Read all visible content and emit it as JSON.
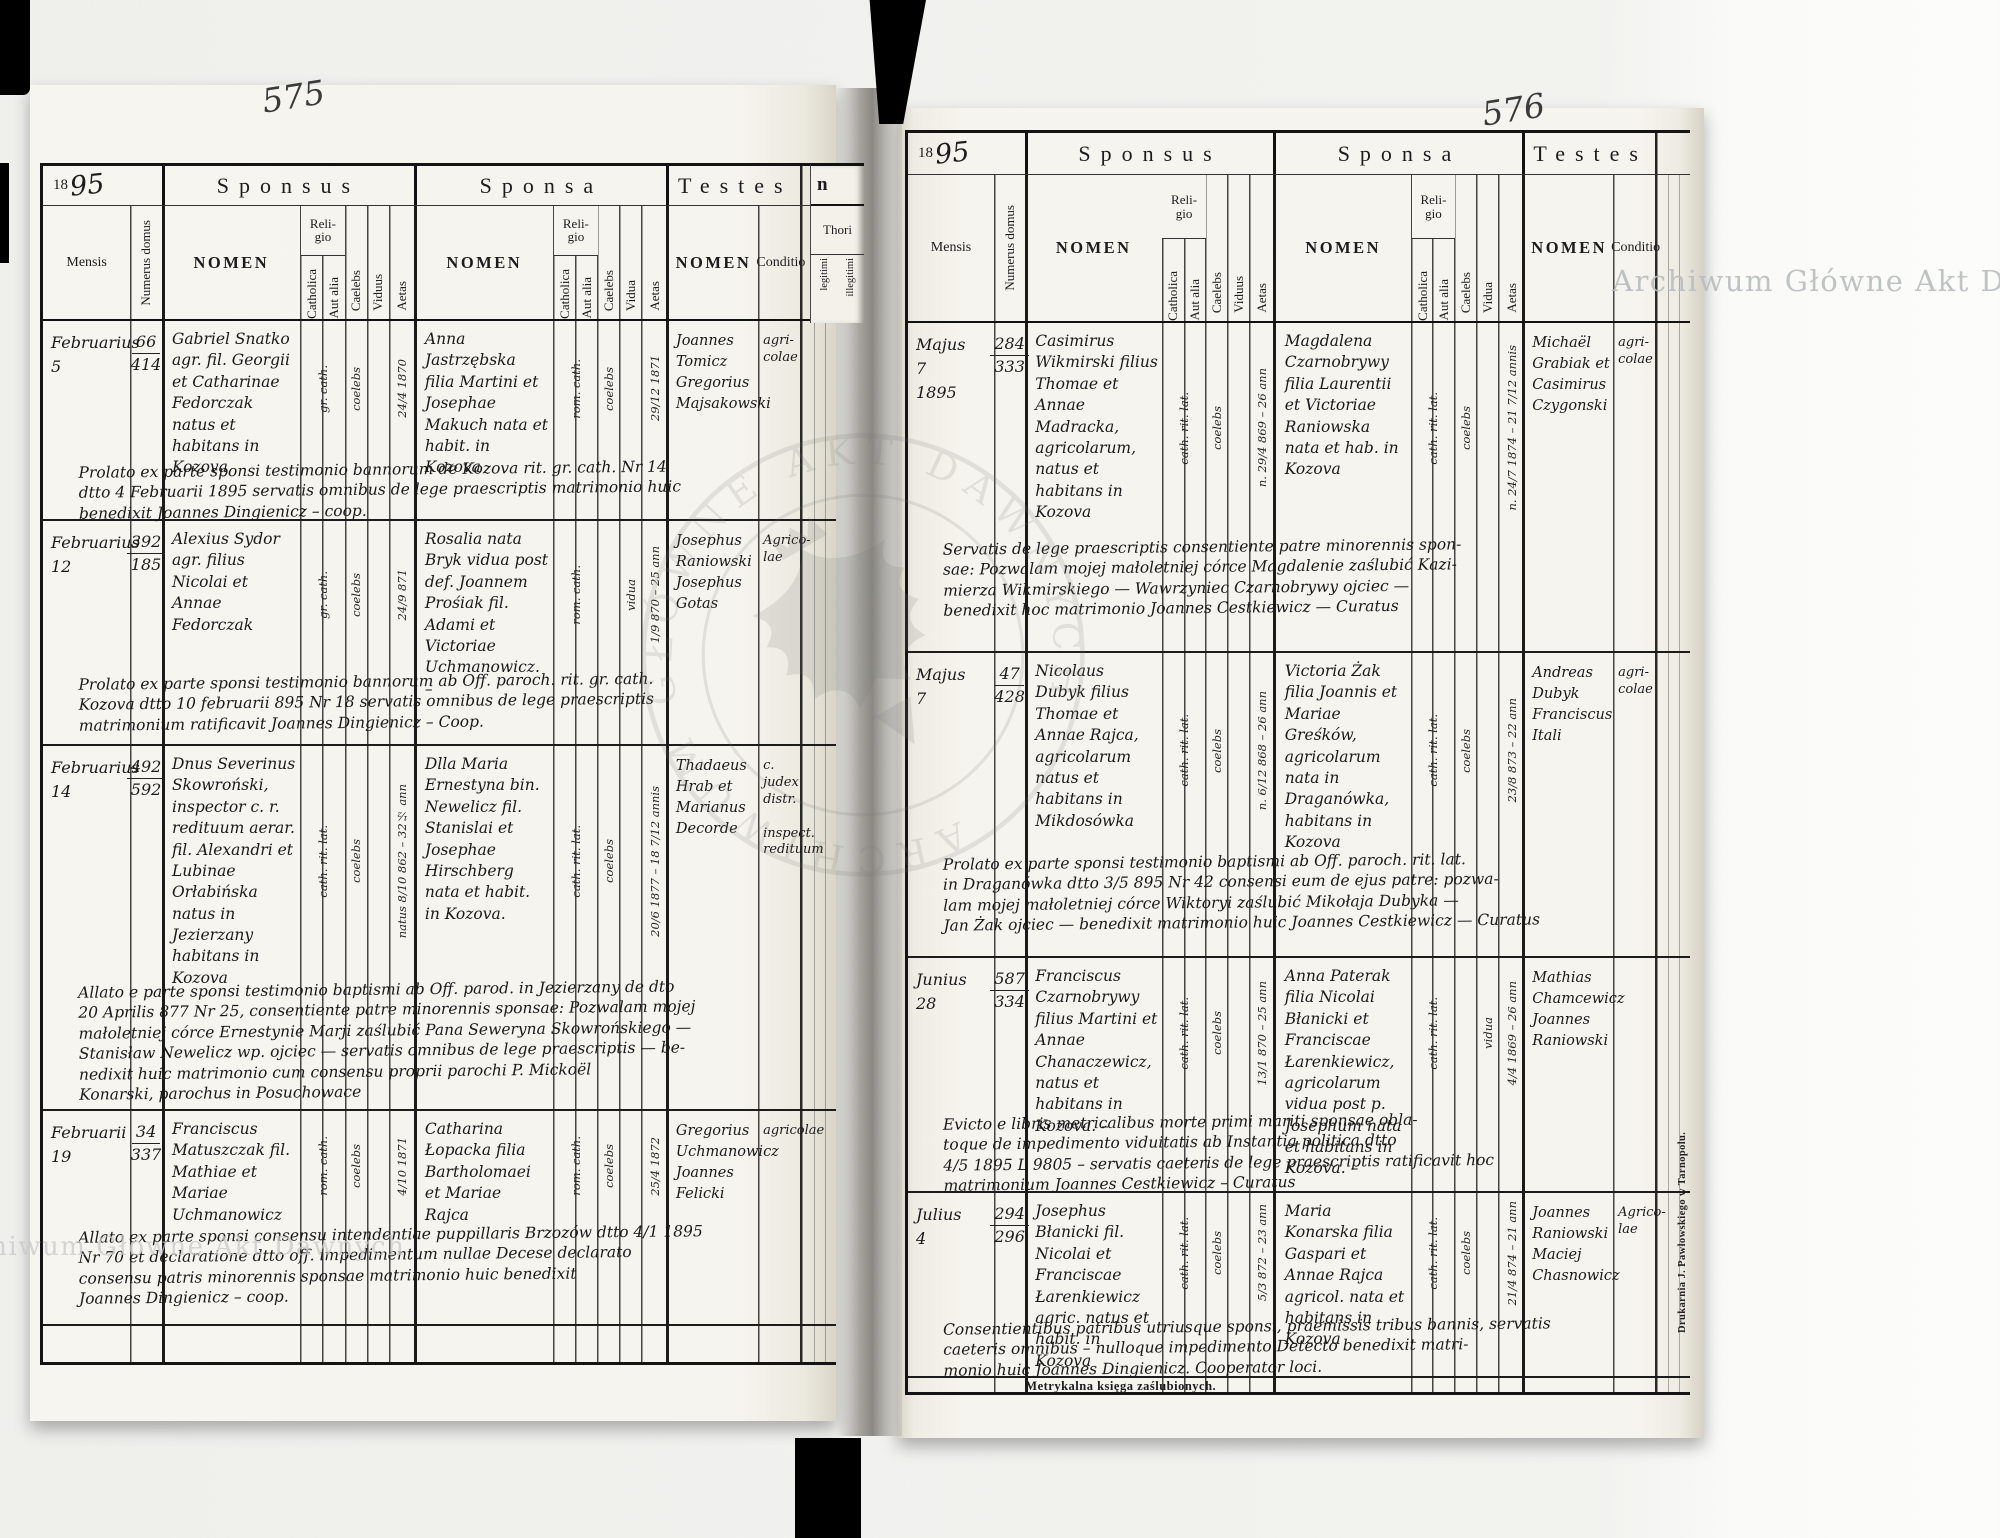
{
  "watermarks": {
    "archive": "Archiwum Główne Akt Dawnych",
    "stamp_text": "ARCHIWUM GŁÓWNE AKT DAWNYCH"
  },
  "headers": {
    "year_printed": "18",
    "sponsus": "Sponsus",
    "sponsa": "Sponsa",
    "testes": "Testes",
    "mensis": "Mensis",
    "numerus_domus": "Numerus domus",
    "nomen": "NOMEN",
    "religio": "Reli-\ngio",
    "catholica": "Catholica",
    "aut_alia": "Aut alia",
    "caelebs": "Caelebs",
    "viduus": "Viduus",
    "vidua": "Vidua",
    "aetas": "Aetas",
    "conditio": "Conditio",
    "fragment_n": "n",
    "thori": "Thori",
    "legitimi": "legitimi",
    "illegitimi": "illegitimi"
  },
  "left": {
    "page_number": "575",
    "year_hand": "95",
    "entries": [
      {
        "mensis": "Februarius\n5",
        "num_top": "66",
        "num_bot": "414",
        "sponsus": "Gabriel Snatko agr. fil. Georgii et Catharinae Fedorczak natus et habitans in Kozova",
        "sp_religio": "gr. cath.",
        "sp_status": "coelebs",
        "sp_aetas": "24/4 1870",
        "sponsa": "Anna Jastrzębska filia Martini et Josephae Makuch nata et habit. in Kozova",
        "sa_religio": "rom. cath.",
        "sa_status": "coelebs",
        "sa_aetas": "29/12 1871",
        "testes": "Joannes Tomicz Gregorius Majsakowski",
        "conditio": "agri-\ncolae",
        "note": "Prolato ex parte sponsi testimonio bannorum de Kozova rit. gr. cath. Nr 14\ndtto 4 Februarii 1895 servatis omnibus de lege praescriptis matrimonio huic\nbenedixit Joannes Dingienicz – coop."
      },
      {
        "mensis": "Februarius\n12",
        "num_top": "392",
        "num_bot": "185",
        "sponsus": "Alexius Sydor agr. filius Nicolai et Annae Fedorczak",
        "sp_religio": "gr. cath.",
        "sp_status": "coelebs",
        "sp_aetas": "24/9 871",
        "sponsa": "Rosalia nata Bryk vidua post def. Joannem Prośiak fil. Adami et Victoriae Uchmanowicz. –",
        "sa_religio": "rom. cath.",
        "sa_status": "vidua",
        "sa_aetas": "1/9 870 – 25 ann",
        "testes": "Josephus Raniowski Josephus Gotas",
        "conditio": "Agrico-\nlae",
        "note": "Prolato ex parte sponsi testimonio bannorum ab Off. paroch. rit. gr. cath.\nKozova dtto 10 februarii 895 Nr 18 servatis omnibus de lege praescriptis\nmatrimonium ratificavit Joannes Dingienicz – Coop."
      },
      {
        "mensis": "Februarius\n14",
        "num_top": "492",
        "num_bot": "592",
        "sponsus": "Dnus Severinus Skowroński, inspector c. r. redituum aerar. fil. Alexandri et Lubinae Orłabińska natus in Jezierzany habitans in Kozova",
        "sp_religio": "cath. rit. lat.",
        "sp_status": "coelebs",
        "sp_aetas": "natus 8/10 862 – 32½ ann",
        "sponsa": "Dlla Maria Ernestyna bin. Newelicz fil. Stanislai et Josephae Hirschberg nata et habit. in Kozova.",
        "sa_religio": "cath. rit. lat.",
        "sa_status": "coelebs",
        "sa_aetas": "20/6 1877 – 18 7/12 annis",
        "testes": "Thadaeus Hrab et Marianus Decorde",
        "conditio": "c. judex distr.\n\ninspect. redituum",
        "note": "Allato e parte sponsi testimonio baptismi ab Off. parod. in Jezierzany de dto\n20 Aprilis 877 Nr 25, consentiente patre minorennis sponsae: Pozwalam mojej\nmałoletniej córce Ernestynie Marji zaślubić Pana Seweryna Skowrońskiego —\nStanisław Newelicz wp. ojciec — servatis omnibus de lege praescriptis — be-\nnedixit huic matrimonio cum consensu proprii parochi P. Mickoël\nKonarski, parochus in Posuchowace"
      },
      {
        "mensis": "Februarii\n19",
        "num_top": "34",
        "num_bot": "337",
        "sponsus": "Franciscus Matuszczak fil. Mathiae et Mariae Uchmanowicz",
        "sp_religio": "rom. cath.",
        "sp_status": "coelebs",
        "sp_aetas": "4/10 1871",
        "sponsa": "Catharina Łopacka filia Bartholomaei et Mariae Rajca",
        "sa_religio": "rom. cath.",
        "sa_status": "coelebs",
        "sa_aetas": "25/4 1872",
        "testes": "Gregorius Uchmanowicz Joannes Felicki",
        "conditio": "agricolae",
        "note": "Allato ex parte sponsi consensu intendentiae puppillaris Brzozów dtto 4/1 1895\nNr 70 et declaratione dtto off. impedimentum nullae Decese declarato\nconsensu patris minorennis sponsae matrimonio huic benedixit\nJoannes Dingienicz – coop."
      }
    ]
  },
  "right": {
    "page_number": "576",
    "year_hand": "95",
    "caption": "Metrykalna księga zaślubionych.",
    "printer": "Drukarnia J. Pawłowskiego w Tarnopolu.",
    "entries": [
      {
        "mensis": "Majus\n7\n1895",
        "num_top": "284",
        "num_bot": "333",
        "sponsus": "Casimirus Wikmirski filius Thomae et Annae Madracka, agricolarum, natus et habitans in Kozova",
        "sp_religio": "cath. rit. lat.",
        "sp_status": "coelebs",
        "sp_aetas": "n. 29/4 869 – 26 ann",
        "sponsa": "Magdalena Czarnobrywy filia Laurentii et Victoriae Raniowska nata et hab. in Kozova",
        "sa_religio": "cath. rit. lat.",
        "sa_status": "coelebs",
        "sa_aetas": "n. 24/7 1874 – 21 7/12 annis",
        "testes": "Michaël Grabiak et Casimirus Czygonski",
        "conditio": "agri-\ncolae",
        "note": "Servatis de lege praescriptis consentiente patre minorennis spon-\nsae: Pozwalam mojej małoletniej córce Magdalenie zaślubić Kazi-\nmierza Wikmirskiego — Wawrzyniec Czarnobrywy ojciec —\nbenedixit hoc matrimonio Joannes Cestkiewicz — Curatus"
      },
      {
        "mensis": "Majus\n7",
        "num_top": "47",
        "num_bot": "428",
        "sponsus": "Nicolaus Dubyk filius Thomae et Annae Rajca, agricolarum natus et habitans in Mikdosówka",
        "sp_religio": "cath. rit. lat.",
        "sp_status": "coelebs",
        "sp_aetas": "n. 6/12 868 – 26 ann",
        "sponsa": "Victoria Żak filia Joannis et Mariae Greśków, agricolarum nata in Draganówka, habitans in Kozova",
        "sa_religio": "cath. rit. lat.",
        "sa_status": "coelebs",
        "sa_aetas": "23/8 873 – 22 ann",
        "testes": "Andreas Dubyk Franciscus Itali",
        "conditio": "agri-\ncolae",
        "note": "Prolato ex parte sponsi testimonio baptismi ab Off. paroch. rit. lat.\nin Draganówka dtto 3/5 895 Nr 42 consensi eum de ejus patre: pozwa-\nlam mojej małoletniej córce Wiktoryi zaślubić Mikołaja Dubyka —\nJan Żak ojciec — benedixit matrimonio huic Joannes Cestkiewicz — Curatus"
      },
      {
        "mensis": "Junius\n28",
        "num_top": "587",
        "num_bot": "334",
        "sponsus": "Franciscus Czarnobrywy filius Martini et Annae Chanaczewicz, natus et habitans in Kozova. –",
        "sp_religio": "cath. rit. lat.",
        "sp_status": "coelebs",
        "sp_aetas": "13/1 870 – 25 ann",
        "sponsa": "Anna Paterak filia Nicolai Błanicki et Franciscae Łarenkiewicz, agricolarum vidua post p. Josephum nata et habitans in Kozova. –",
        "sa_religio": "cath. rit. lat.",
        "sa_status": "vidua",
        "sa_aetas": "4/4 1869 – 26 ann",
        "testes": "Mathias Chamcewicz Joannes Raniowski",
        "conditio": "",
        "note": "Evicto e libris metricalibus morte primi mariti sponsae obla-\ntoque de impedimento viduitatis ab Instantia politica dtto\n4/5 1895 L 9805 – servatis caeteris de lege praescriptis ratificavit hoc\nmatrimonium Joannes Cestkiewicz – Curatus"
      },
      {
        "mensis": "Julius\n4",
        "num_top": "294",
        "num_bot": "296",
        "sponsus": "Josephus Błanicki fil. Nicolai et Franciscae Łarenkiewicz agric. natus et habit. in Kozova",
        "sp_religio": "cath. rit. lat.",
        "sp_status": "coelebs",
        "sp_aetas": "5/3 872 – 23 ann",
        "sponsa": "Maria Konarska filia Gaspari et Annae Rajca agricol. nata et habitans in Kozova",
        "sa_religio": "cath. rit. lat.",
        "sa_status": "coelebs",
        "sa_aetas": "21/4 874 – 21 ann",
        "testes": "Joannes Raniowski Maciej Chasnowicz",
        "conditio": "Agrico-\nlae",
        "note": "Consentientibus patribus utriusque sponsi, praemissis tribus bannis, servatis\ncaeteris omnibus – nulloque impedimento Detecto benedixit matri-\nmonio huic Joannes Dingienicz. Cooperator loci."
      }
    ]
  }
}
